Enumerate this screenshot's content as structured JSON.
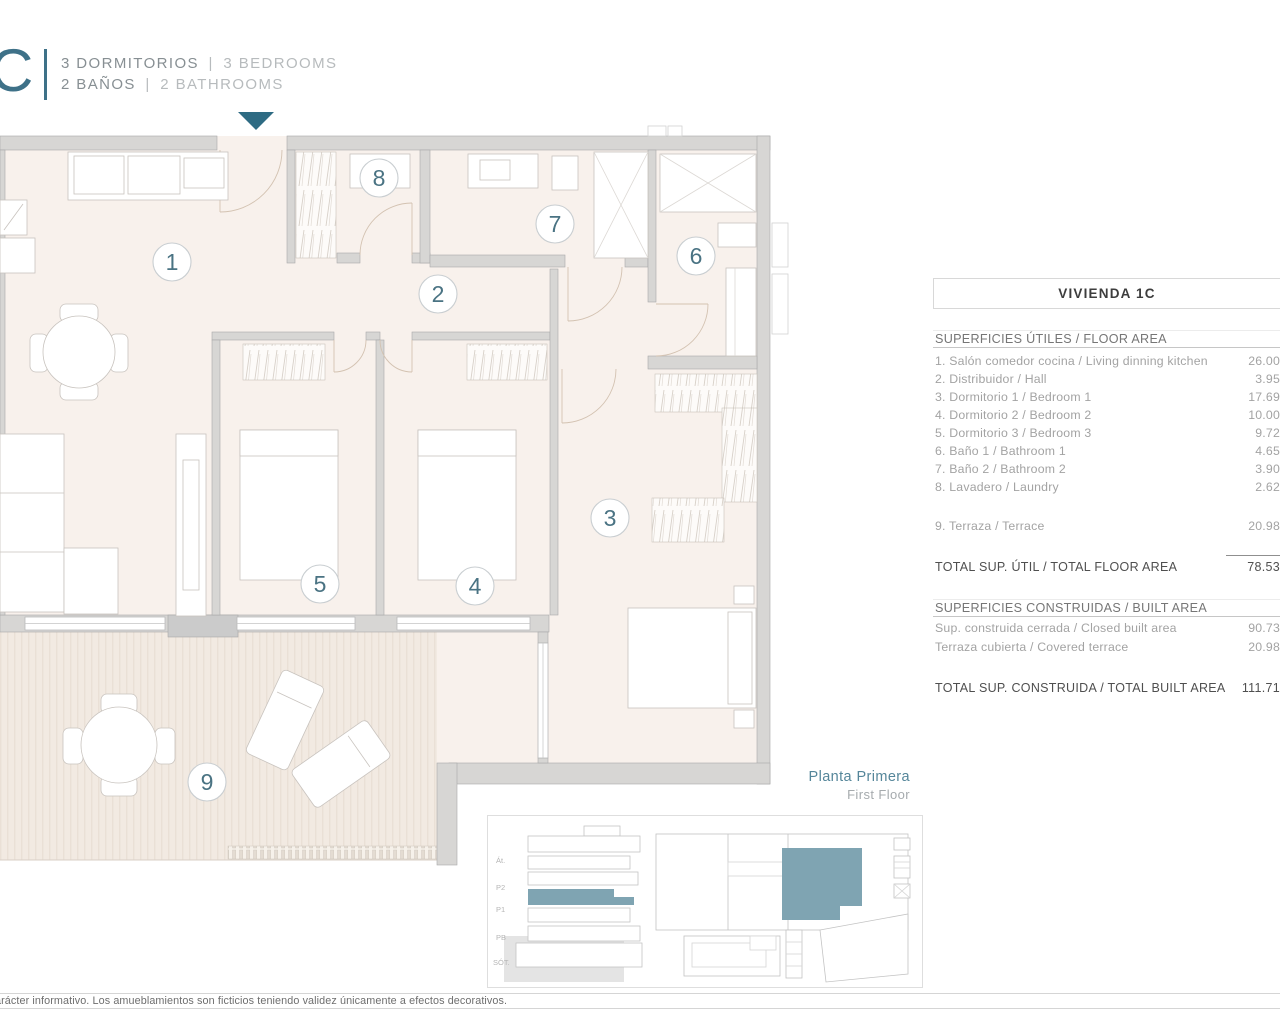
{
  "header": {
    "logo_letter": "C",
    "lines": [
      {
        "primary": "3 DORMITORIOS",
        "sep": "|",
        "secondary": "3 BEDROOMS"
      },
      {
        "primary": "2 BAÑOS",
        "sep": "|",
        "secondary": "2 BATHROOMS"
      }
    ]
  },
  "plan": {
    "rooms": [
      {
        "label": "1"
      },
      {
        "label": "2"
      },
      {
        "label": "3"
      },
      {
        "label": "4"
      },
      {
        "label": "5"
      },
      {
        "label": "6"
      },
      {
        "label": "7"
      },
      {
        "label": "8"
      },
      {
        "label": "9"
      }
    ]
  },
  "area_table": {
    "title": "VIVIENDA 1C",
    "floor_area": {
      "header": "SUPERFICIES ÚTILES / FLOOR AREA",
      "rows": [
        {
          "label": "1. Salón comedor cocina / Living dinning kitchen",
          "value": "26.00"
        },
        {
          "label": "2. Distribuidor / Hall",
          "value": "3.95"
        },
        {
          "label": "3. Dormitorio 1 / Bedroom 1",
          "value": "17.69"
        },
        {
          "label": "4. Dormitorio 2 / Bedroom 2",
          "value": "10.00"
        },
        {
          "label": "5. Dormitorio 3 / Bedroom 3",
          "value": "9.72"
        },
        {
          "label": "6. Baño 1 / Bathroom 1",
          "value": "4.65"
        },
        {
          "label": "7. Baño 2 / Bathroom 2",
          "value": "3.90"
        },
        {
          "label": "8. Lavadero / Laundry",
          "value": "2.62"
        }
      ],
      "terrace_row": {
        "label": "9. Terraza / Terrace",
        "value": "20.98"
      },
      "total": {
        "label": "TOTAL SUP. ÚTIL / TOTAL FLOOR AREA",
        "value": "78.53"
      }
    },
    "built_area": {
      "header": "SUPERFICIES CONSTRUIDAS / BUILT AREA",
      "rows": [
        {
          "label": "Sup. construida cerrada / Closed built area",
          "value": "90.73"
        },
        {
          "label": "Terraza cubierta / Covered terrace",
          "value": "20.98"
        }
      ],
      "total": {
        "label": "TOTAL SUP. CONSTRUIDA /  TOTAL BUILT AREA",
        "value": "111.71"
      }
    }
  },
  "floor_label": {
    "primary": "Planta Primera",
    "secondary": "First Floor"
  },
  "site_inset": {
    "floor_labels": [
      "Át.",
      "P2",
      "P1",
      "PB",
      "SÓT."
    ]
  },
  "footer": {
    "text": "arácter informativo. Los amueblamientos son ficticios teniendo validez únicamente a efectos decorativos."
  },
  "colors": {
    "accent": "#3e7188",
    "highlight": "#7fa4b2",
    "room_number": "#4a7383"
  }
}
